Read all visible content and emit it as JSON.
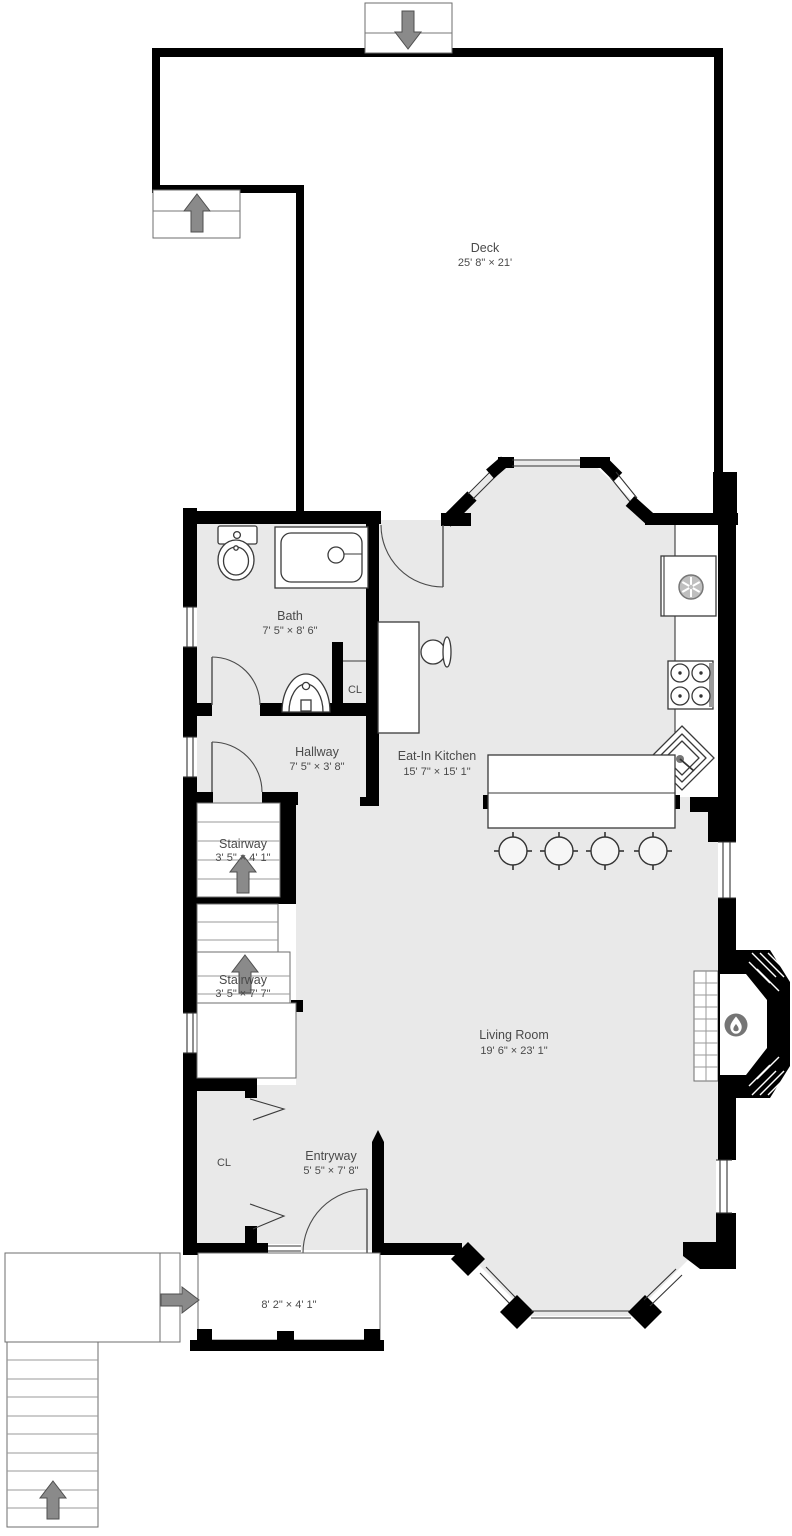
{
  "plan": {
    "rooms": [
      {
        "id": "deck",
        "name": "Deck",
        "dims": "25' 8\" × 21'"
      },
      {
        "id": "bath",
        "name": "Bath",
        "dims": "7' 5\" × 8' 6\""
      },
      {
        "id": "hallway",
        "name": "Hallway",
        "dims": "7' 5\" × 3' 8\""
      },
      {
        "id": "eat-in-kitchen",
        "name": "Eat-In Kitchen",
        "dims": "15' 7\" × 15' 1\""
      },
      {
        "id": "stairway-upper",
        "name": "Stairway",
        "dims": "3' 5\" × 4' 1\""
      },
      {
        "id": "stairway-lower",
        "name": "Stairway",
        "dims": "3' 5\" × 7' 7\""
      },
      {
        "id": "living-room",
        "name": "Living Room",
        "dims": "19' 6\" × 23' 1\""
      },
      {
        "id": "entryway",
        "name": "Entryway",
        "dims": "5' 5\" × 7' 8\""
      }
    ],
    "closet_label": "CL",
    "porch": {
      "dims": "8' 2\" × 4' 1\""
    },
    "markers": {
      "deck_top_entrance": "down-arrow",
      "deck_side_landing": "up-arrow",
      "stairway_upper": "up-arrow",
      "stairway_lower": "up-arrow",
      "porch_step": "right-arrow",
      "exterior_stairs": "up-arrow",
      "fireplace": "flame-icon",
      "refrigerator": "fan-icon"
    },
    "colors": {
      "wall": "#000000",
      "floor": "#e9e9e9",
      "arrow": "#8a8a8a",
      "label": "#4a4a4a",
      "flame_badge": "#757575"
    }
  }
}
